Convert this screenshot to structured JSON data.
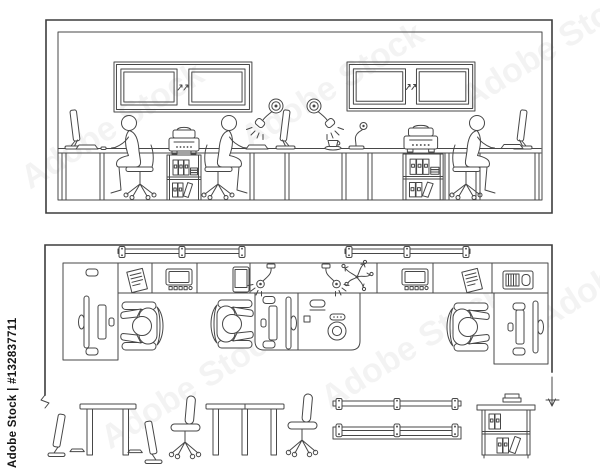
{
  "watermark": {
    "side_text": "Adobe Stock | #132837711",
    "tile_text": "Adobe Stock"
  },
  "palette": {
    "background": "#ffffff",
    "line": "#474747",
    "wall_line": "#3d3d3d",
    "watermark_text": "#161616"
  },
  "scene": {
    "description_elements": {
      "elevation_view": [
        "room-wall-frame",
        "double-window",
        "double-window",
        "desk-counter",
        "desk-monitor",
        "keyboard",
        "mouse",
        "seated-worker-on-office-chair",
        "printer",
        "shelf-unit-with-binders",
        "seated-worker-on-office-chair",
        "keyboard",
        "desk-monitor",
        "articulated-wall-lamp",
        "articulated-wall-lamp",
        "coffee-cup",
        "small-desk-lamp",
        "printer",
        "shelf-unit-with-binders",
        "seated-worker-on-office-chair",
        "keyboard",
        "desk-monitor"
      ],
      "plan_view": [
        "room-walls",
        "ceiling-light-fixture",
        "ceiling-light-fixture",
        "worktop-strip",
        "corner-desk",
        "corner-desk",
        "corner-desk",
        "document",
        "desktop-computer-top",
        "tablet",
        "wall-lamp-top",
        "wall-lamp-top",
        "plant-top",
        "desktop-computer-top",
        "document",
        "printer-top",
        "telephone",
        "speakerphone",
        "mug",
        "monitor-top",
        "keyboard-top",
        "mouse-top",
        "seated-worker-top",
        "seated-worker-top",
        "seated-worker-top",
        "wall-break-mark",
        "direction-arrow"
      ],
      "furniture_row": [
        "monitor-side",
        "keyboard-side",
        "two-leg-table",
        "monitor-side",
        "keyboard-side",
        "office-chair-side",
        "three-leg-table",
        "office-chair-side",
        "linear-light-fixture-plan",
        "linear-light-fixture-plan",
        "bookshelf-with-books"
      ]
    }
  }
}
